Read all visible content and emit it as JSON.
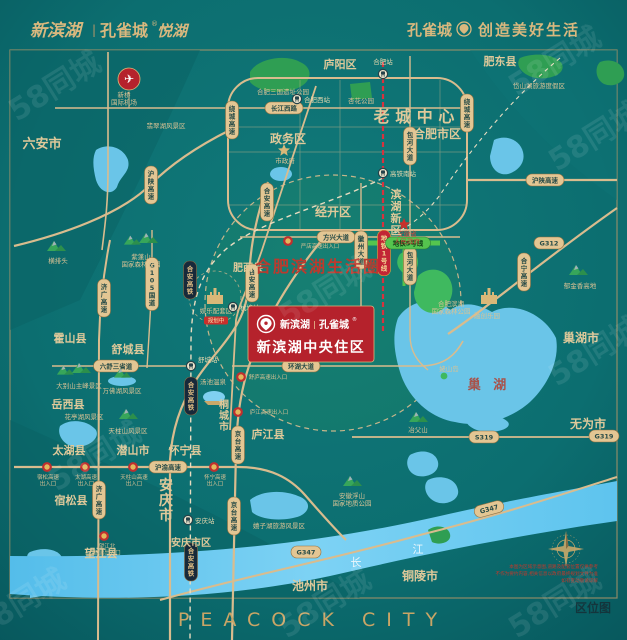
{
  "header": {
    "logo_name": "新滨湖",
    "logo_sep": "|",
    "logo_brand": "孔雀城",
    "logo_reg": "®",
    "logo_sub": "悦湖",
    "slogan_brand": "孔雀城",
    "slogan_text": "创造美好生活"
  },
  "footer": {
    "wordmark": "PEACOCK CITY",
    "map_type_label": "区位图"
  },
  "watermark": {
    "text": "58同城"
  },
  "colors": {
    "background_teal": "#0b6d6f",
    "gold_accent": "#d9b87e",
    "road_tan": "#d9bc8e",
    "brand_red": "#b5222c",
    "metro_red": "#d8323e",
    "metro_green": "#55c44e",
    "water_blue": "#6ac5e8",
    "park_green": "#2f9e53"
  },
  "project_card": {
    "logo_name": "新滨湖",
    "logo_sep": "|",
    "logo_brand": "孔雀城",
    "logo_reg": "®",
    "title": "新滨湖中央住区"
  },
  "life_circle_label": "合肥滨湖生活圈",
  "map": {
    "labels": [
      {
        "t": "六安市",
        "x": 42,
        "y": 148,
        "s": 13,
        "b": 1
      },
      {
        "t": "庐阳区",
        "x": 340,
        "y": 68,
        "s": 11,
        "b": 1
      },
      {
        "t": "肥东县",
        "x": 500,
        "y": 65,
        "s": 11,
        "b": 1
      },
      {
        "t": "老 城 中 心",
        "x": 414,
        "y": 122,
        "s": 16,
        "b": 1
      },
      {
        "t": "合肥市区",
        "x": 437,
        "y": 138,
        "s": 12,
        "b": 1
      },
      {
        "t": "政务区",
        "x": 288,
        "y": 143,
        "s": 12,
        "b": 1
      },
      {
        "t": "经开区",
        "x": 333,
        "y": 216,
        "s": 12,
        "b": 1
      },
      {
        "t": "滨湖新区",
        "x": 396,
        "y": 198,
        "s": 11,
        "b": 1,
        "v": 1
      },
      {
        "t": "肥西县",
        "x": 248,
        "y": 271,
        "s": 10,
        "b": 1
      },
      {
        "t": "巢湖市",
        "x": 581,
        "y": 342,
        "s": 12,
        "b": 1
      },
      {
        "t": "无为市",
        "x": 588,
        "y": 428,
        "s": 12,
        "b": 1
      },
      {
        "t": "舒城县",
        "x": 128,
        "y": 353,
        "s": 11,
        "b": 1
      },
      {
        "t": "霍山县",
        "x": 70,
        "y": 342,
        "s": 11,
        "b": 1
      },
      {
        "t": "岳西县",
        "x": 68,
        "y": 408,
        "s": 11,
        "b": 1
      },
      {
        "t": "太湖县",
        "x": 69,
        "y": 454,
        "s": 11,
        "b": 1
      },
      {
        "t": "潜山市",
        "x": 133,
        "y": 454,
        "s": 11,
        "b": 1
      },
      {
        "t": "怀宁县",
        "x": 185,
        "y": 454,
        "s": 11,
        "b": 1
      },
      {
        "t": "宿松县",
        "x": 71,
        "y": 504,
        "s": 11,
        "b": 1
      },
      {
        "t": "望江县",
        "x": 101,
        "y": 557,
        "s": 11,
        "b": 1
      },
      {
        "t": "桐城市",
        "x": 224,
        "y": 408,
        "s": 10,
        "b": 1,
        "v": 1
      },
      {
        "t": "庐江县",
        "x": 268,
        "y": 438,
        "s": 11,
        "b": 1
      },
      {
        "t": "安庆市",
        "x": 166,
        "y": 490,
        "s": 14,
        "b": 1,
        "v": 1
      },
      {
        "t": "安庆市区",
        "x": 191,
        "y": 546,
        "s": 10,
        "b": 1
      },
      {
        "t": "池州市",
        "x": 310,
        "y": 590,
        "s": 12,
        "b": 1
      },
      {
        "t": "铜陵市",
        "x": 420,
        "y": 580,
        "s": 12,
        "b": 1
      },
      {
        "t": "巢 湖",
        "x": 489,
        "y": 389,
        "s": 13,
        "c": "lake"
      },
      {
        "t": "长",
        "x": 356,
        "y": 566,
        "s": 11,
        "c": "white"
      },
      {
        "t": "江",
        "x": 418,
        "y": 553,
        "s": 11,
        "c": "white"
      }
    ],
    "pois": [
      {
        "icon": "pl",
        "ix": 129,
        "iy": 79,
        "lines": [
          "新桥",
          "国际机场"
        ],
        "x": 124,
        "y": 97
      },
      {
        "t": "翡翠湖风景区",
        "x": 166,
        "y": 128
      },
      {
        "t": "合肥三国遗址公园",
        "x": 283,
        "y": 94
      },
      {
        "t": "杏花公园",
        "x": 361,
        "y": 103
      },
      {
        "t": "岱山湖旅游度假区",
        "x": 539,
        "y": 88
      },
      {
        "icon": "m2",
        "ix": 140,
        "iy": 241,
        "lines": [
          "紫蓬山",
          "国家森林公园"
        ],
        "x": 141,
        "y": 259
      },
      {
        "icon": "m",
        "ix": 56,
        "iy": 247,
        "t": "横排头",
        "x": 58,
        "y": 263
      },
      {
        "icon": "sg",
        "ix": 284,
        "iy": 150,
        "t": "市政府",
        "x": 285,
        "y": 163
      },
      {
        "icon": "sr",
        "ix": 404,
        "iy": 224,
        "lines": [
          "安徽省",
          "人民政府"
        ],
        "x": 407,
        "y": 236,
        "red": 1
      },
      {
        "lines": [
          "合肥滨湖",
          "国家森林公园"
        ],
        "x": 451,
        "y": 306
      },
      {
        "t": "姥山岛",
        "x": 449,
        "y": 371
      },
      {
        "icon": "m",
        "ix": 578,
        "iy": 271,
        "t": "郁金香高地",
        "x": 580,
        "y": 288
      },
      {
        "icon": "c",
        "ix": 489,
        "iy": 297,
        "t": "融创乐园",
        "x": 487,
        "y": 318
      },
      {
        "icon": "c",
        "ix": 215,
        "iy": 297,
        "t": "娱乐配套区",
        "x": 216,
        "y": 313,
        "sub": "规划中"
      },
      {
        "icon": "sp",
        "ix": 214,
        "iy": 397,
        "t": "汤池温泉",
        "x": 213,
        "y": 384
      },
      {
        "icon": "mw",
        "ix": 122,
        "iy": 374,
        "t": "万佛湖风景区",
        "x": 122,
        "y": 393
      },
      {
        "icon": "m2",
        "ix": 73,
        "iy": 371,
        "t": "大别山主峰景区",
        "x": 79,
        "y": 388
      },
      {
        "icon": "m",
        "ix": 128,
        "iy": 415,
        "t": "天柱山风景区",
        "x": 128,
        "y": 433
      },
      {
        "t": "花亭湖风景区",
        "x": 84,
        "y": 419
      },
      {
        "t": "嬉子湖旅游风景区",
        "x": 279,
        "y": 528
      },
      {
        "icon": "m",
        "ix": 418,
        "iy": 418,
        "t": "冶父山",
        "x": 418,
        "y": 432
      },
      {
        "icon": "m",
        "ix": 352,
        "iy": 482,
        "lines": [
          "安徽浮山",
          "国家地质公园"
        ],
        "x": 352,
        "y": 498
      }
    ],
    "stations": [
      {
        "t": "合肥站",
        "x": 383,
        "y": 74,
        "lx": 383,
        "ly": 64,
        "a": "middle"
      },
      {
        "t": "合肥西站",
        "x": 297,
        "y": 99,
        "lx": 304,
        "ly": 102,
        "a": "start"
      },
      {
        "t": "高铁南站",
        "x": 383,
        "y": 173,
        "lx": 390,
        "ly": 176,
        "a": "start"
      },
      {
        "t": "杭埠站",
        "x": 233,
        "y": 307,
        "lx": 240,
        "ly": 310,
        "a": "start"
      },
      {
        "t": "舒城站",
        "x": 191,
        "y": 366,
        "lx": 198,
        "ly": 362,
        "a": "start"
      },
      {
        "t": "安庆站",
        "x": 188,
        "y": 520,
        "lx": 195,
        "ly": 523,
        "a": "start"
      }
    ],
    "pills": [
      {
        "t": "长江西路",
        "x": 284,
        "y": 108,
        "k": "r"
      },
      {
        "t": "绕城高速",
        "x": 232,
        "y": 120,
        "k": "r",
        "v": 1
      },
      {
        "t": "绕城高速",
        "x": 467,
        "y": 113,
        "k": "r",
        "v": 1
      },
      {
        "t": "沪陕高速",
        "x": 151,
        "y": 185,
        "k": "r",
        "v": 1
      },
      {
        "t": "沪陕高速",
        "x": 545,
        "y": 180,
        "k": "r"
      },
      {
        "t": "合宁高速",
        "x": 524,
        "y": 272,
        "k": "r",
        "v": 1
      },
      {
        "t": "G312",
        "x": 549,
        "y": 243,
        "k": "r"
      },
      {
        "t": "合安高速",
        "x": 267,
        "y": 202,
        "k": "r",
        "v": 1
      },
      {
        "t": "合安高速",
        "x": 252,
        "y": 283,
        "k": "r",
        "v": 1
      },
      {
        "t": "京台高速",
        "x": 238,
        "y": 445,
        "k": "r",
        "v": 1
      },
      {
        "t": "京台高速",
        "x": 234,
        "y": 516,
        "k": "r",
        "v": 1
      },
      {
        "t": "济广高速",
        "x": 104,
        "y": 298,
        "k": "r",
        "v": 1
      },
      {
        "t": "济广高速",
        "x": 99,
        "y": 500,
        "k": "r",
        "v": 1
      },
      {
        "t": "G105国道",
        "x": 152,
        "y": 284,
        "k": "r",
        "v": 1
      },
      {
        "t": "六舒三省道",
        "x": 116,
        "y": 366,
        "k": "r"
      },
      {
        "t": "沪渝高速",
        "x": 168,
        "y": 467,
        "k": "r"
      },
      {
        "t": "合安高铁",
        "x": 190,
        "y": 280,
        "k": "d",
        "v": 1
      },
      {
        "t": "合安高铁",
        "x": 191,
        "y": 396,
        "k": "d",
        "v": 1
      },
      {
        "t": "合安高铁",
        "x": 191,
        "y": 562,
        "k": "d",
        "v": 1
      },
      {
        "t": "方兴大道",
        "x": 336,
        "y": 237,
        "k": "r"
      },
      {
        "t": "徽州大道",
        "x": 361,
        "y": 250,
        "k": "r",
        "v": 1
      },
      {
        "t": "包河大道",
        "x": 410,
        "y": 146,
        "k": "r",
        "v": 1
      },
      {
        "t": "包河大道",
        "x": 410,
        "y": 266,
        "k": "r",
        "v": 1
      },
      {
        "t": "桃林路",
        "x": 301,
        "y": 312,
        "k": "r"
      },
      {
        "t": "环湖大道",
        "x": 301,
        "y": 366,
        "k": "r"
      },
      {
        "t": "S319",
        "x": 484,
        "y": 437,
        "k": "r"
      },
      {
        "t": "G319",
        "x": 604,
        "y": 436,
        "k": "r"
      },
      {
        "t": "G347",
        "x": 489,
        "y": 509,
        "k": "r",
        "rot": -15
      },
      {
        "t": "G347",
        "x": 306,
        "y": 552,
        "k": "r"
      },
      {
        "t": "地铁1号线",
        "x": 384,
        "y": 253,
        "k": "m",
        "v": 1
      },
      {
        "t": "地铁5号线",
        "x": 408,
        "y": 243,
        "k": "g"
      }
    ],
    "exits": [
      {
        "lines": [
          "严店高速出入口"
        ],
        "x": 320,
        "y": 248,
        "ix": 288,
        "iy": 241
      },
      {
        "lines": [
          "舒庐高速出入口"
        ],
        "x": 268,
        "y": 379,
        "ix": 241,
        "iy": 377
      },
      {
        "lines": [
          "庐江高速出入口"
        ],
        "x": 269,
        "y": 414,
        "ix": 238,
        "iy": 412
      },
      {
        "lines": [
          "宿松高速",
          "出入口"
        ],
        "x": 48,
        "y": 479,
        "ix": 47,
        "iy": 467
      },
      {
        "lines": [
          "太湖高速",
          "出入口"
        ],
        "x": 86,
        "y": 479,
        "ix": 85,
        "iy": 467
      },
      {
        "lines": [
          "天柱山高速",
          "出入口"
        ],
        "x": 134,
        "y": 479,
        "ix": 133,
        "iy": 467
      },
      {
        "lines": [
          "怀宁高速",
          "出入口"
        ],
        "x": 215,
        "y": 479,
        "ix": 214,
        "iy": 467
      },
      {
        "lines": [
          "望江北",
          "高速出入口"
        ],
        "x": 107,
        "y": 548,
        "ix": 104,
        "iy": 536
      }
    ],
    "disclaimer": [
      "本图为区域示意图,道路及配套位置仅供参考",
      "不作为要约内容,相关信息以政府最终规划文件为准",
      "如有变动敬请谅解"
    ]
  }
}
